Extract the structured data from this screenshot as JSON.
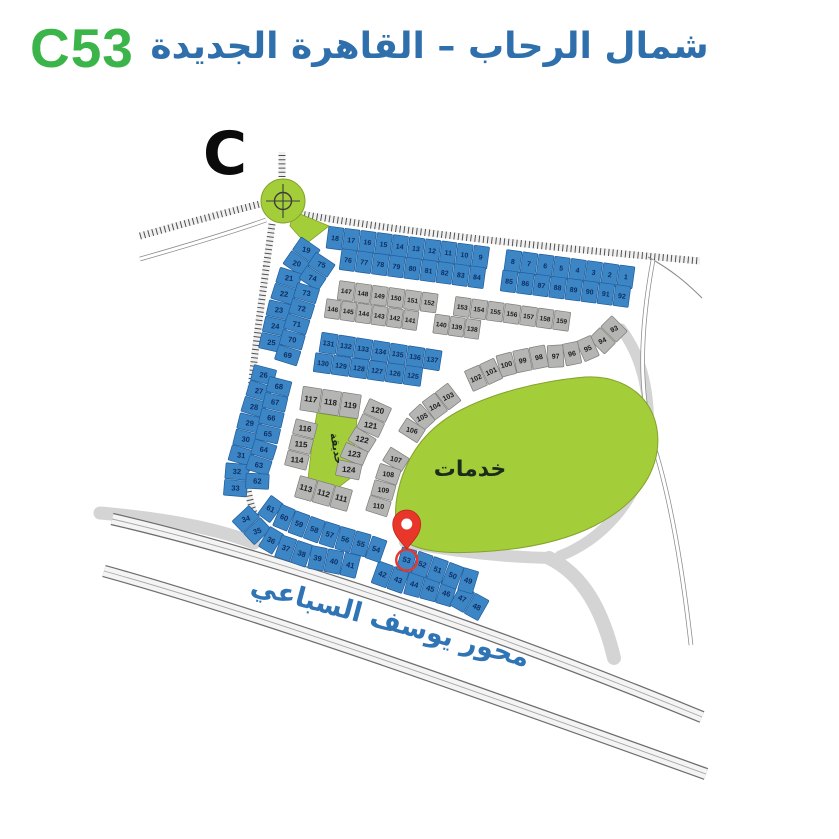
{
  "header": {
    "plot_code": "C53",
    "title": "شمال الرحاب – القاهرة الجديدة"
  },
  "map": {
    "section_letter": "C",
    "road_label": "محور يوسف السباعي",
    "services_label": "خدمات",
    "garden_label": "حديقة",
    "selected_plot": "53",
    "colors": {
      "header_code_green": "#3bb44a",
      "title_blue": "#2e6fac",
      "road_label_blue": "#2f74b5",
      "plot_blue": "#3d86c6",
      "plot_blue_border": "#1f5c9c",
      "plot_gray": "#b5b5b3",
      "plot_gray_border": "#7c7c78",
      "green_area": "#a4cd3a",
      "green_border": "#84a32c",
      "number_navy": "#0e2f63",
      "number_black": "#1c1c1c",
      "pin_red": "#e8362b"
    },
    "bands": [
      {
        "id": "T1",
        "type": "blue",
        "numbers": [
          18,
          17,
          16,
          15,
          14,
          13,
          12,
          11,
          10,
          9,
          8,
          7,
          6,
          5,
          4,
          3,
          2,
          1
        ]
      },
      {
        "id": "T2",
        "type": "blue",
        "numbers": [
          76,
          77,
          78,
          79,
          80,
          81,
          82,
          83,
          84,
          85,
          86,
          87,
          88,
          89,
          90,
          91,
          92
        ]
      },
      {
        "id": "G1",
        "type": "gray",
        "numbers": [
          147,
          148,
          149,
          150,
          151,
          152,
          153,
          154,
          155,
          156,
          157,
          158,
          159
        ]
      },
      {
        "id": "G2",
        "type": "gray",
        "numbers": [
          146,
          145,
          144,
          143,
          142,
          141,
          140,
          139,
          138
        ]
      },
      {
        "id": "B3",
        "type": "blue",
        "numbers": [
          131,
          132,
          133,
          134,
          135,
          136,
          137
        ]
      },
      {
        "id": "B4",
        "type": "blue",
        "numbers": [
          130,
          129,
          128,
          127,
          126,
          125
        ]
      },
      {
        "id": "L1",
        "type": "blue",
        "numbers": [
          19,
          20,
          21,
          22,
          23,
          24,
          25,
          26,
          27,
          28,
          29,
          30,
          31,
          32,
          33,
          34,
          35,
          36,
          37,
          38,
          39,
          40,
          41,
          42,
          43,
          44,
          45,
          46,
          47,
          48
        ]
      },
      {
        "id": "L2",
        "type": "blue",
        "numbers": [
          75,
          74,
          73,
          72,
          71,
          70,
          69,
          68,
          67,
          66,
          65,
          64,
          63,
          62,
          61,
          60,
          59,
          58,
          57,
          56,
          55,
          54,
          53,
          52,
          51,
          50,
          49
        ]
      },
      {
        "id": "GR",
        "type": "gray",
        "numbers": [
          93,
          94,
          95,
          96,
          97,
          98,
          99,
          100,
          101,
          102,
          103,
          104,
          105,
          106,
          107,
          108,
          109,
          110
        ]
      },
      {
        "id": "CU1",
        "type": "gray",
        "numbers": [
          117,
          118,
          119
        ]
      },
      {
        "id": "CU2",
        "type": "gray",
        "numbers": [
          120,
          121,
          122,
          123,
          124
        ]
      },
      {
        "id": "CU3",
        "type": "gray",
        "numbers": [
          116,
          115,
          114
        ]
      },
      {
        "id": "CU4",
        "type": "gray",
        "numbers": [
          113,
          112,
          111
        ]
      }
    ]
  }
}
